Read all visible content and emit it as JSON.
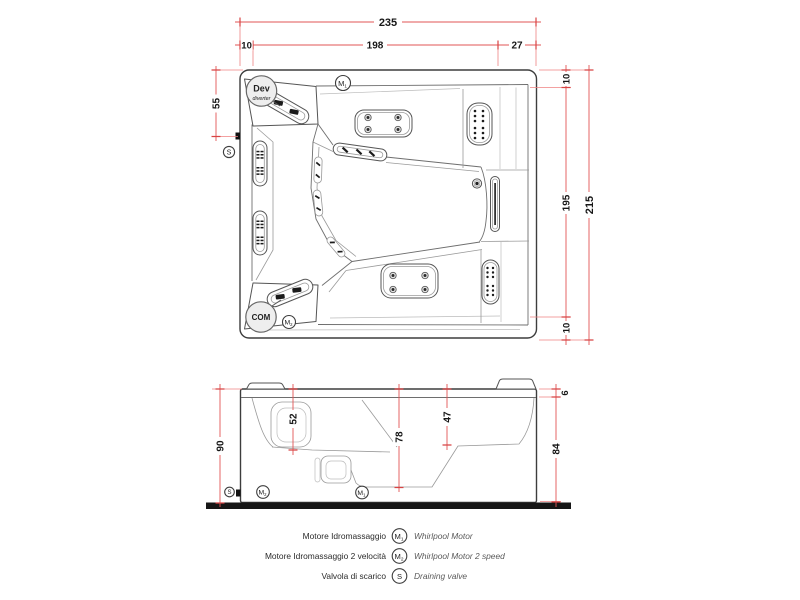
{
  "drawing": {
    "type": "technical dimension drawing",
    "subject": "whirlpool bathtub - plan view and side elevation"
  },
  "colors": {
    "dimension_line": "#e25555",
    "outline": "#3d3d3d",
    "ground": "#161616",
    "badge_fill": "#eeeeee"
  },
  "top_view": {
    "dims": {
      "total_width": "235",
      "left_edge": "10",
      "opening_width": "198",
      "right_section": "27",
      "valve_offset": "55",
      "rim_top": "10",
      "opening_depth": "195",
      "rim_bottom": "10",
      "total_depth": "215"
    }
  },
  "side_view": {
    "dims": {
      "overall_height": "90",
      "backrest_depth": "52",
      "basin_depth": "78",
      "seat_height": "47",
      "rim_thickness": "6",
      "skirt_height": "84"
    }
  },
  "symbols": {
    "diverter_title": "Dev",
    "diverter_sub": "diverter",
    "control": "COM",
    "motor": "M",
    "motor1_sub": "1",
    "motor2_sub": "2",
    "valve": "S"
  },
  "legend": {
    "rows": [
      {
        "it": "Motore Idromassaggio",
        "symbol": "M",
        "sub": "1",
        "en": "Whirlpool Motor"
      },
      {
        "it": "Motore Idromassaggio 2 velocità",
        "symbol": "M",
        "sub": "2",
        "en": "Whirlpool Motor 2 speed"
      },
      {
        "it": "Valvola di scarico",
        "symbol": "S",
        "sub": "",
        "en": "Draining valve"
      }
    ]
  }
}
